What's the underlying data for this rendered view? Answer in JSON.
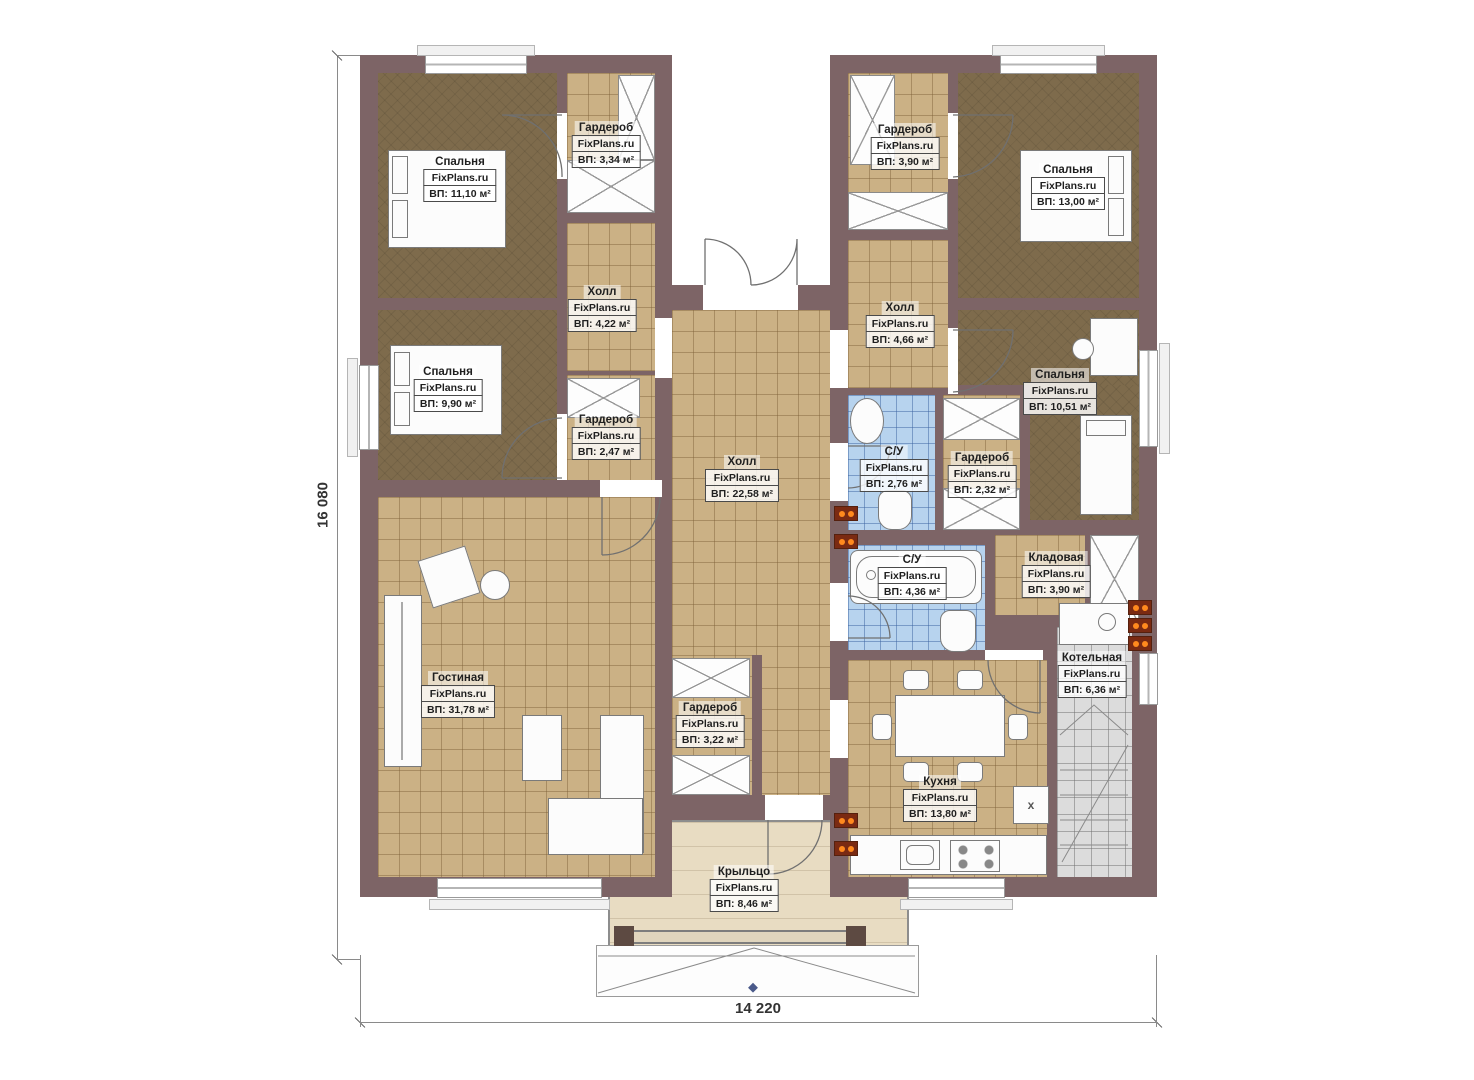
{
  "brand": "FixPlans.ru",
  "dimensions": {
    "height": "16 080",
    "width": "14 220"
  },
  "icons": {
    "fridge_mark": "x"
  },
  "colors": {
    "wall": "#7d6466",
    "floor_tile": "#cbb185",
    "floor_bedroom": "#7e6b4c",
    "floor_bathroom": "#b7d3ee",
    "floor_boiler": "#dcdcdc",
    "floor_porch": "#e8dcc2",
    "radiator": "#ff8a1e"
  },
  "rooms": {
    "bedroom_tl": {
      "name": "Спальня",
      "area": "ВП: 11,10 м²"
    },
    "wardrobe_tl": {
      "name": "Гардероб",
      "area": "ВП: 3,34 м²"
    },
    "hall_left": {
      "name": "Холл",
      "area": "ВП: 4,22 м²"
    },
    "bedroom_ml": {
      "name": "Спальня",
      "area": "ВП: 9,90 м²"
    },
    "wardrobe_ml": {
      "name": "Гардероб",
      "area": "ВП: 2,47 м²"
    },
    "living": {
      "name": "Гостиная",
      "area": "ВП: 31,78 м²"
    },
    "hall_main": {
      "name": "Холл",
      "area": "ВП: 22,58 м²"
    },
    "wardrobe_center": {
      "name": "Гардероб",
      "area": "ВП: 3,22 м²"
    },
    "porch": {
      "name": "Крыльцо",
      "area": "ВП: 8,46 м²"
    },
    "wardrobe_tr": {
      "name": "Гардероб",
      "area": "ВП: 3,90 м²"
    },
    "bedroom_tr": {
      "name": "Спальня",
      "area": "ВП: 13,00 м²"
    },
    "hall_right": {
      "name": "Холл",
      "area": "ВП: 4,66 м²"
    },
    "bedroom_mr": {
      "name": "Спальня",
      "area": "ВП: 10,51 м²"
    },
    "bathroom_small": {
      "name": "С/У",
      "area": "ВП: 2,76 м²"
    },
    "wardrobe_mr": {
      "name": "Гардероб",
      "area": "ВП: 2,32 м²"
    },
    "bathroom_big": {
      "name": "С/У",
      "area": "ВП: 4,36 м²"
    },
    "storage": {
      "name": "Кладовая",
      "area": "ВП: 3,90 м²"
    },
    "boiler": {
      "name": "Котельная",
      "area": "ВП: 6,36 м²"
    },
    "kitchen": {
      "name": "Кухня",
      "area": "ВП: 13,80 м²"
    }
  }
}
